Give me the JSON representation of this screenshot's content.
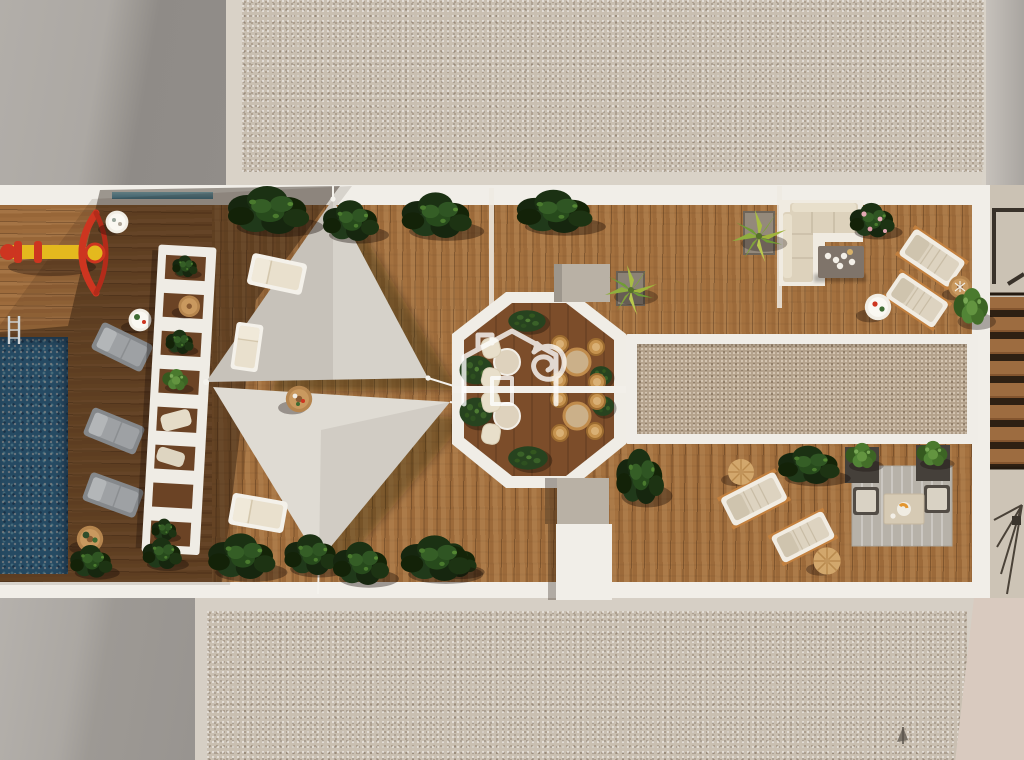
{
  "meta": {
    "kind": "3d-architectural-render",
    "view": "top-down aerial",
    "subject": "rooftop terrace with pool and lounge areas",
    "width_px": 1024,
    "height_px": 760
  },
  "palette": {
    "deck_wood": "#a4713f",
    "deck_wood_shaded": "#5d3c20",
    "octagon_floor": "#7c4d2a",
    "pool_water": "#2d7fb6",
    "sail_upper": "#d6d2ca",
    "sail_lower": "#dfdbd3",
    "walkway_white": "#f1eee8",
    "pergola_white": "#efece5",
    "gravel_roof": "#c9bfb1",
    "gravel_bed": "#b4a28c",
    "concrete_gray": "#a7a39e",
    "plant_dark_green": "#1b3113",
    "plant_light_green": "#4a7a2e",
    "hedge_green": "#27431f",
    "palm_yellow_green": "#9fb43c",
    "cushion_beige": "#ddd2bc",
    "rattan_tan": "#c6934f",
    "lounger_gray": "#8e9194",
    "toy_red": "#cd3520",
    "toy_yellow": "#e4b91e",
    "glass_teal": "#5fa0b5",
    "watermark_white": "#ffffff",
    "rug_gray": "#b7b2a9",
    "planter_dark": "#45403a"
  },
  "objects": [
    {
      "name": "swimming-pool",
      "note": "mosaic water, left edge"
    },
    {
      "name": "pool-ladder",
      "note": "chrome, pool top edge"
    },
    {
      "name": "seesaw-toy",
      "note": "yellow beam, red bow"
    },
    {
      "name": "small-white-table",
      "note": "round, upper-left deck"
    },
    {
      "name": "gray-loungers",
      "count": 3,
      "note": "in building shadow beside pool"
    },
    {
      "name": "slatted-pergola",
      "note": "white ladder frame with plants and chairs beneath"
    },
    {
      "name": "shade-sails",
      "count": 2,
      "note": "triangular, meeting at center"
    },
    {
      "name": "white-loungers",
      "count": 3,
      "note": "sunlit, cream cushions"
    },
    {
      "name": "round-side-tables",
      "count": 6
    },
    {
      "name": "dining-octagon",
      "tables": 4,
      "chairs_rattan": 8,
      "chairs_beige": 4,
      "hedges": 6
    },
    {
      "name": "house-logo-watermark",
      "note": "white house outline with curled cat"
    },
    {
      "name": "gravel-bed-right",
      "note": "white-framed rectangle"
    },
    {
      "name": "corner-sofa-set",
      "note": "beige L sofa with gray coffee table and cups"
    },
    {
      "name": "cream-loungers",
      "count": 4,
      "note": "two top-right, two bottom-right"
    },
    {
      "name": "wooden-poufs",
      "count": 2
    },
    {
      "name": "lounge-rug-set",
      "note": "rug, two dark chairs, planters, low table with food"
    },
    {
      "name": "planted-palms",
      "count": 2,
      "note": "spiky yellow-green in planters"
    },
    {
      "name": "plant-clusters",
      "count": 12,
      "note": "dark tropical bushes along deck edges"
    },
    {
      "name": "stairs-right",
      "note": "wood steps with landings top and bottom"
    },
    {
      "name": "gravel-roof-top",
      "note": "neighbouring roof"
    },
    {
      "name": "gravel-roof-bottom",
      "note": "neighbouring roof"
    },
    {
      "name": "drain-mark",
      "note": "small fitting on bottom gravel"
    }
  ]
}
